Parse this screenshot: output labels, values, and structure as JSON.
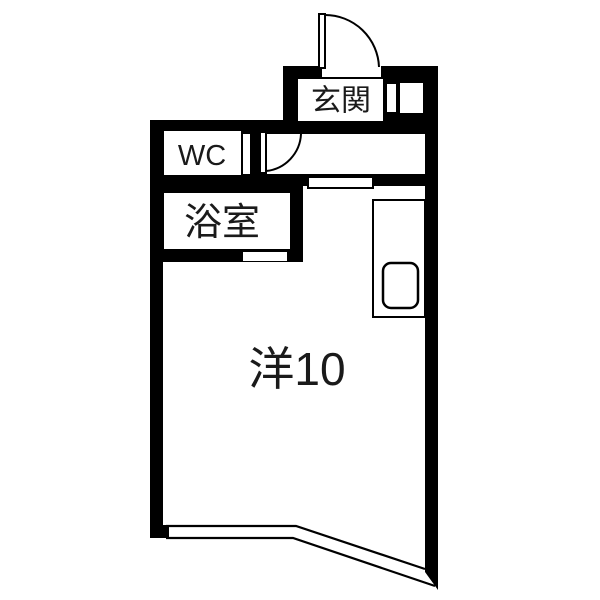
{
  "floorplan": {
    "kind": "japanese-apartment-floor-plan",
    "labels": {
      "entrance": "玄関",
      "toilet": "WC",
      "bathroom": "浴室",
      "main_room": "洋10"
    },
    "colors": {
      "wall": "#000000",
      "floor": "#ffffff",
      "line": "#000000",
      "label_text": "#1a1a1a"
    }
  }
}
